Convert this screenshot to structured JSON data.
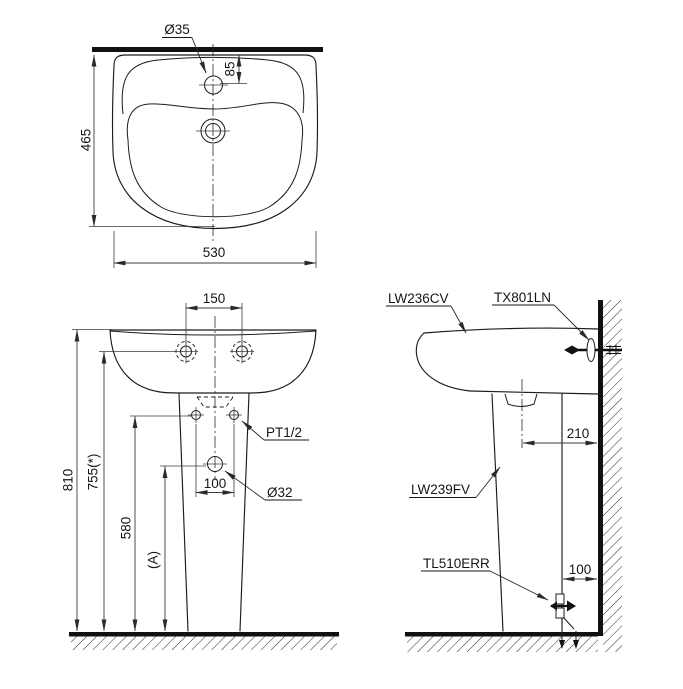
{
  "colors": {
    "line": "#1c1c1c",
    "dim": "#3c3c3c",
    "background": "#ffffff"
  },
  "top_view": {
    "faucet_hole": "Ø35",
    "faucet_offset": "85",
    "depth": "465",
    "width": "530"
  },
  "front_view": {
    "hole_spacing": "150",
    "overall_height": "810",
    "hanger_height": "755(*)",
    "supply_height": "580",
    "trap_height": "(A)",
    "supply_spacing": "100",
    "drain_hole": "Ø32",
    "supply_thread": "PT1/2"
  },
  "side_view": {
    "lavatory_model": "LW236CV",
    "hanger_model": "TX801LN",
    "pedestal_model": "LW239FV",
    "valve_model": "TL510ERR",
    "drain_to_wall": "210",
    "valve_to_wall": "100"
  }
}
